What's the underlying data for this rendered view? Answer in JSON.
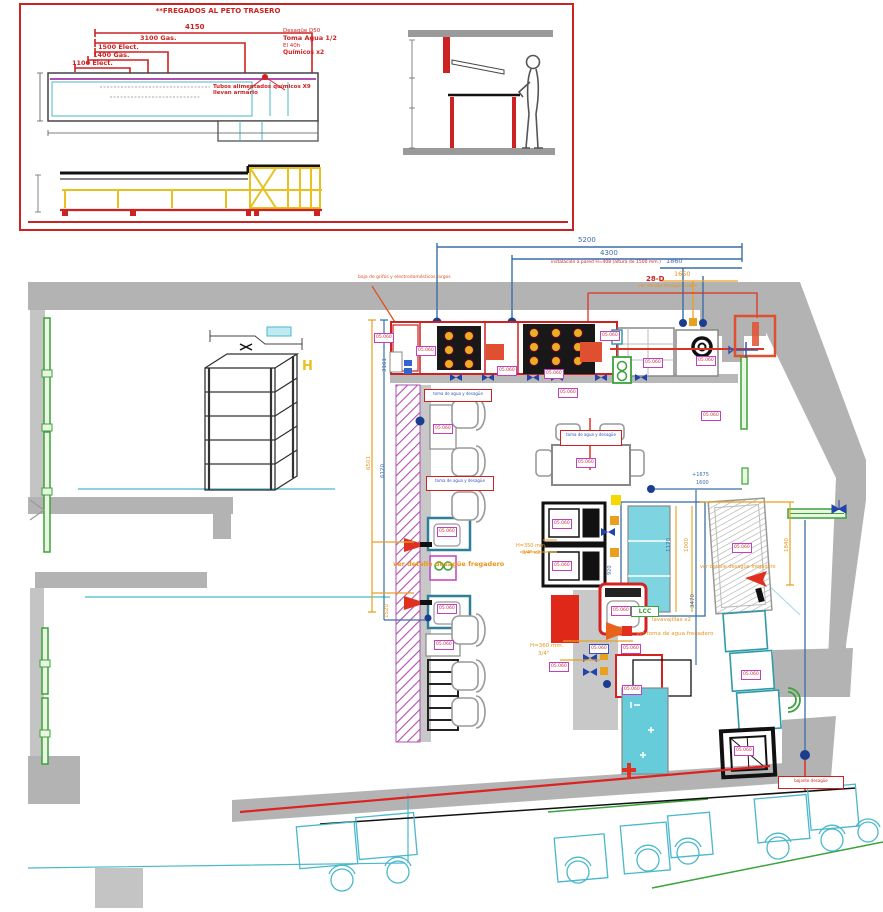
{
  "inset": {
    "title": "**FREGADOS AL PETO TRASERO",
    "dims": [
      "4150",
      "3100 Gas.",
      "1500 Elect.",
      "1400 Gas.",
      "1100 Elect."
    ],
    "supply": [
      "Desagüe D50",
      "Toma Agua 1/2",
      "El 40h",
      "Químicos x2"
    ],
    "pipe_note": "Tubos alimentados químicos X9 llevan armario"
  },
  "plan": {
    "eq_code": "05.060",
    "dims": {
      "d5200": "5200",
      "d4300": "4300",
      "d1860": "1860",
      "d1650": "1650",
      "d3161": "3161",
      "d6501": "6501",
      "d6120": "6120",
      "d1520": "1520",
      "d920": "920",
      "d1675": "+1675",
      "d1600": "1600",
      "d1170": "1170",
      "d1000": "1000",
      "d3470": "3470",
      "d1840": "1840"
    },
    "notes": {
      "code_28d": "28-D",
      "detalle_cobre": "ver detalle desagüe cobre",
      "instalacion": "instalación a pared H=408 (altura de 1500 mm.)",
      "baja": "baja de grifos y electrodomésticos largos",
      "detalle_fregadero_bar": "ver detalle desagüe fregadero",
      "detalle_fregadero_right": "ver detalle desagüe fregadero",
      "lavavajillas": "lavavajillas x2",
      "toma_agua": "ver toma de agua fregadero",
      "h350": "H=350 mm.",
      "h350b": "3/4\" x2",
      "h360": "H=360 mm.",
      "h360b": "3/4\"",
      "lcc": "LCC",
      "h_marker": "H"
    },
    "red_labels": {
      "r1": "toma de agua y desagüe",
      "r2": "toma de agua y desagüe",
      "r3": "toma de agua y desagüe",
      "r4": "bajante desagüe"
    }
  }
}
